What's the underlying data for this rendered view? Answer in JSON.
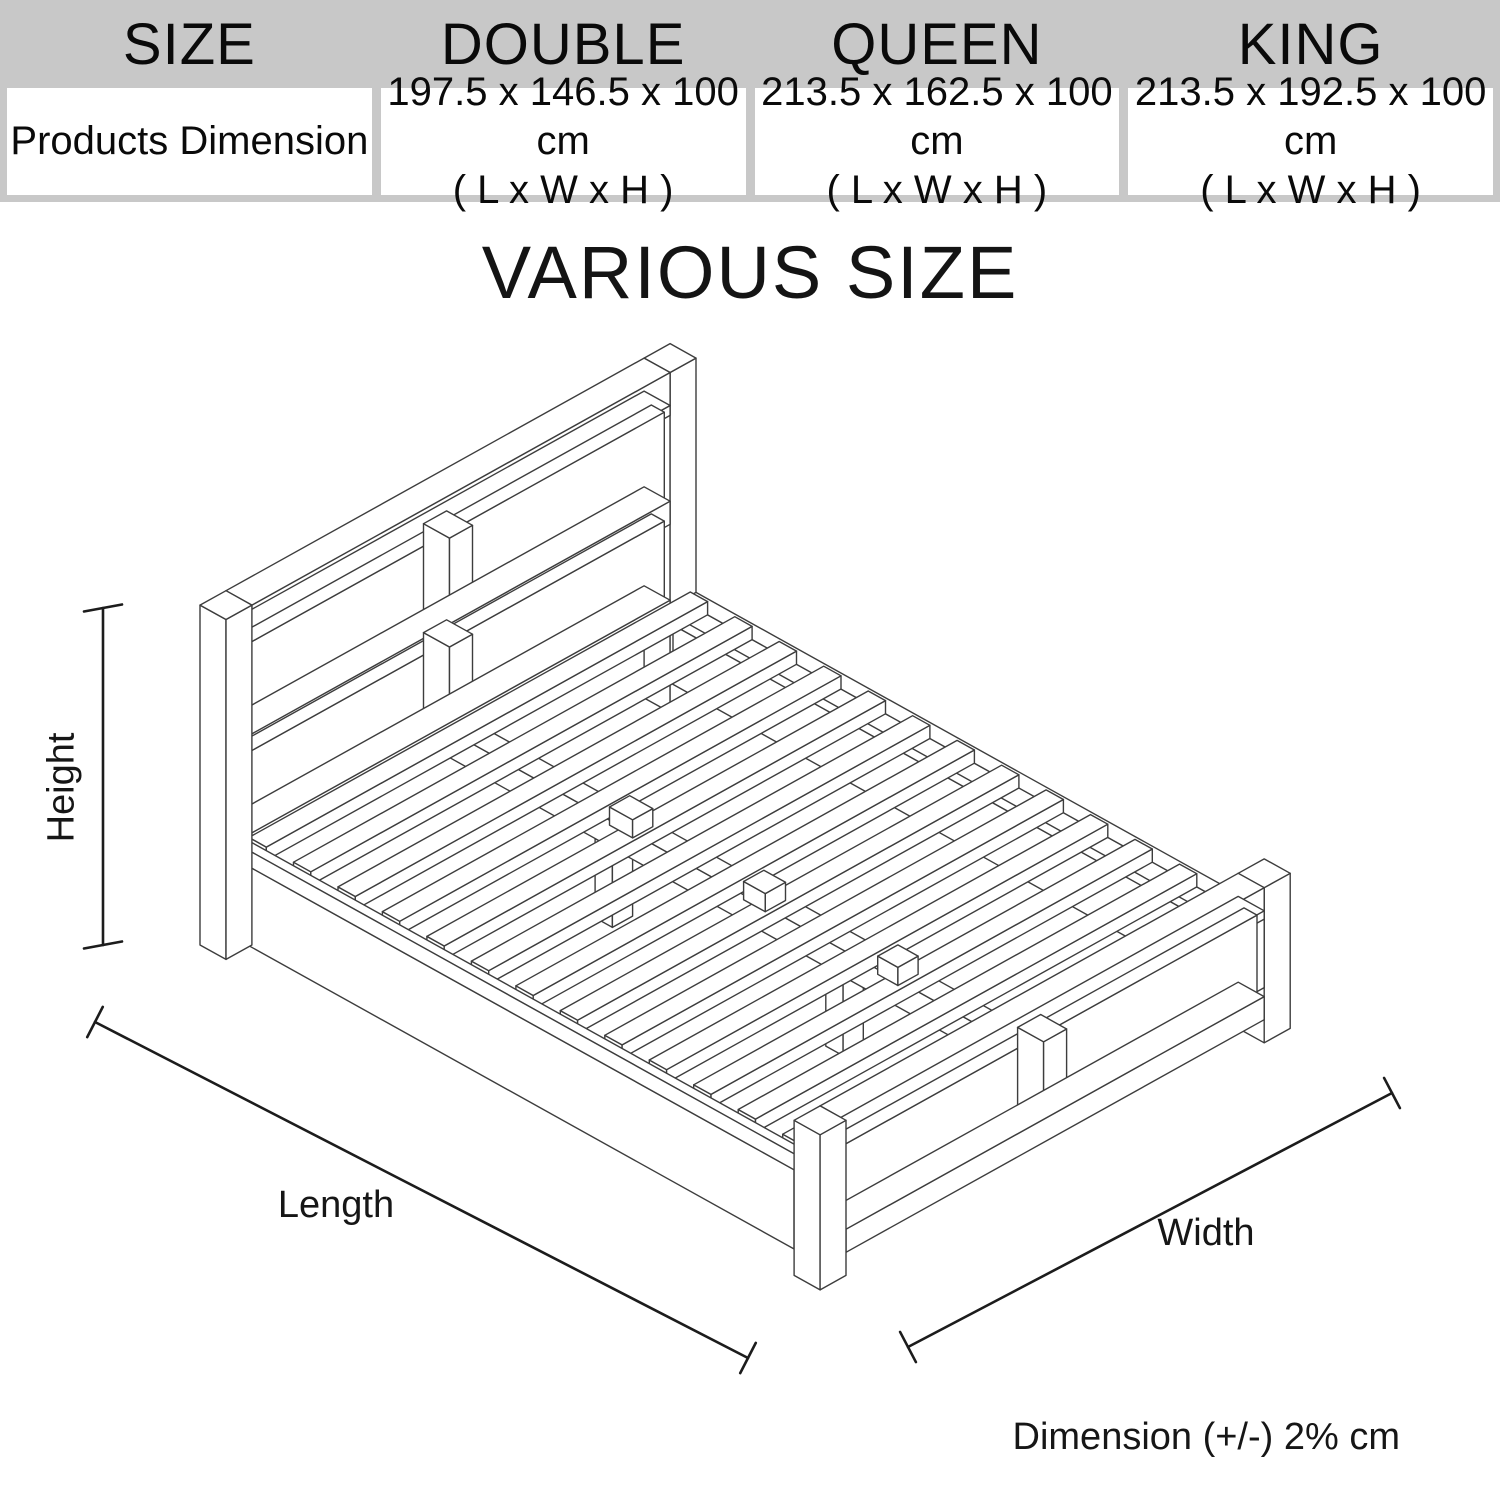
{
  "page": {
    "title": "VARIOUS SIZE",
    "footnote": "Dimension (+/-) 2% cm",
    "background": "#ffffff"
  },
  "table": {
    "header_bg": "#c8c8c8",
    "columns": [
      "SIZE",
      "DOUBLE",
      "QUEEN",
      "KING"
    ],
    "row_label": "Products Dimension",
    "values": [
      {
        "dims": "197.5 x 146.5 x 100 cm",
        "axes": "( L x W x H )"
      },
      {
        "dims": "213.5 x 162.5 x 100 cm",
        "axes": "( L x W x H )"
      },
      {
        "dims": "213.5 x 192.5 x 100 cm",
        "axes": "( L x W x H )"
      }
    ]
  },
  "diagram": {
    "labels": {
      "height": "Height",
      "length": "Length",
      "width": "Width"
    },
    "line_color": "#3d3d3d",
    "dimension_line_color": "#1c1c1c"
  }
}
